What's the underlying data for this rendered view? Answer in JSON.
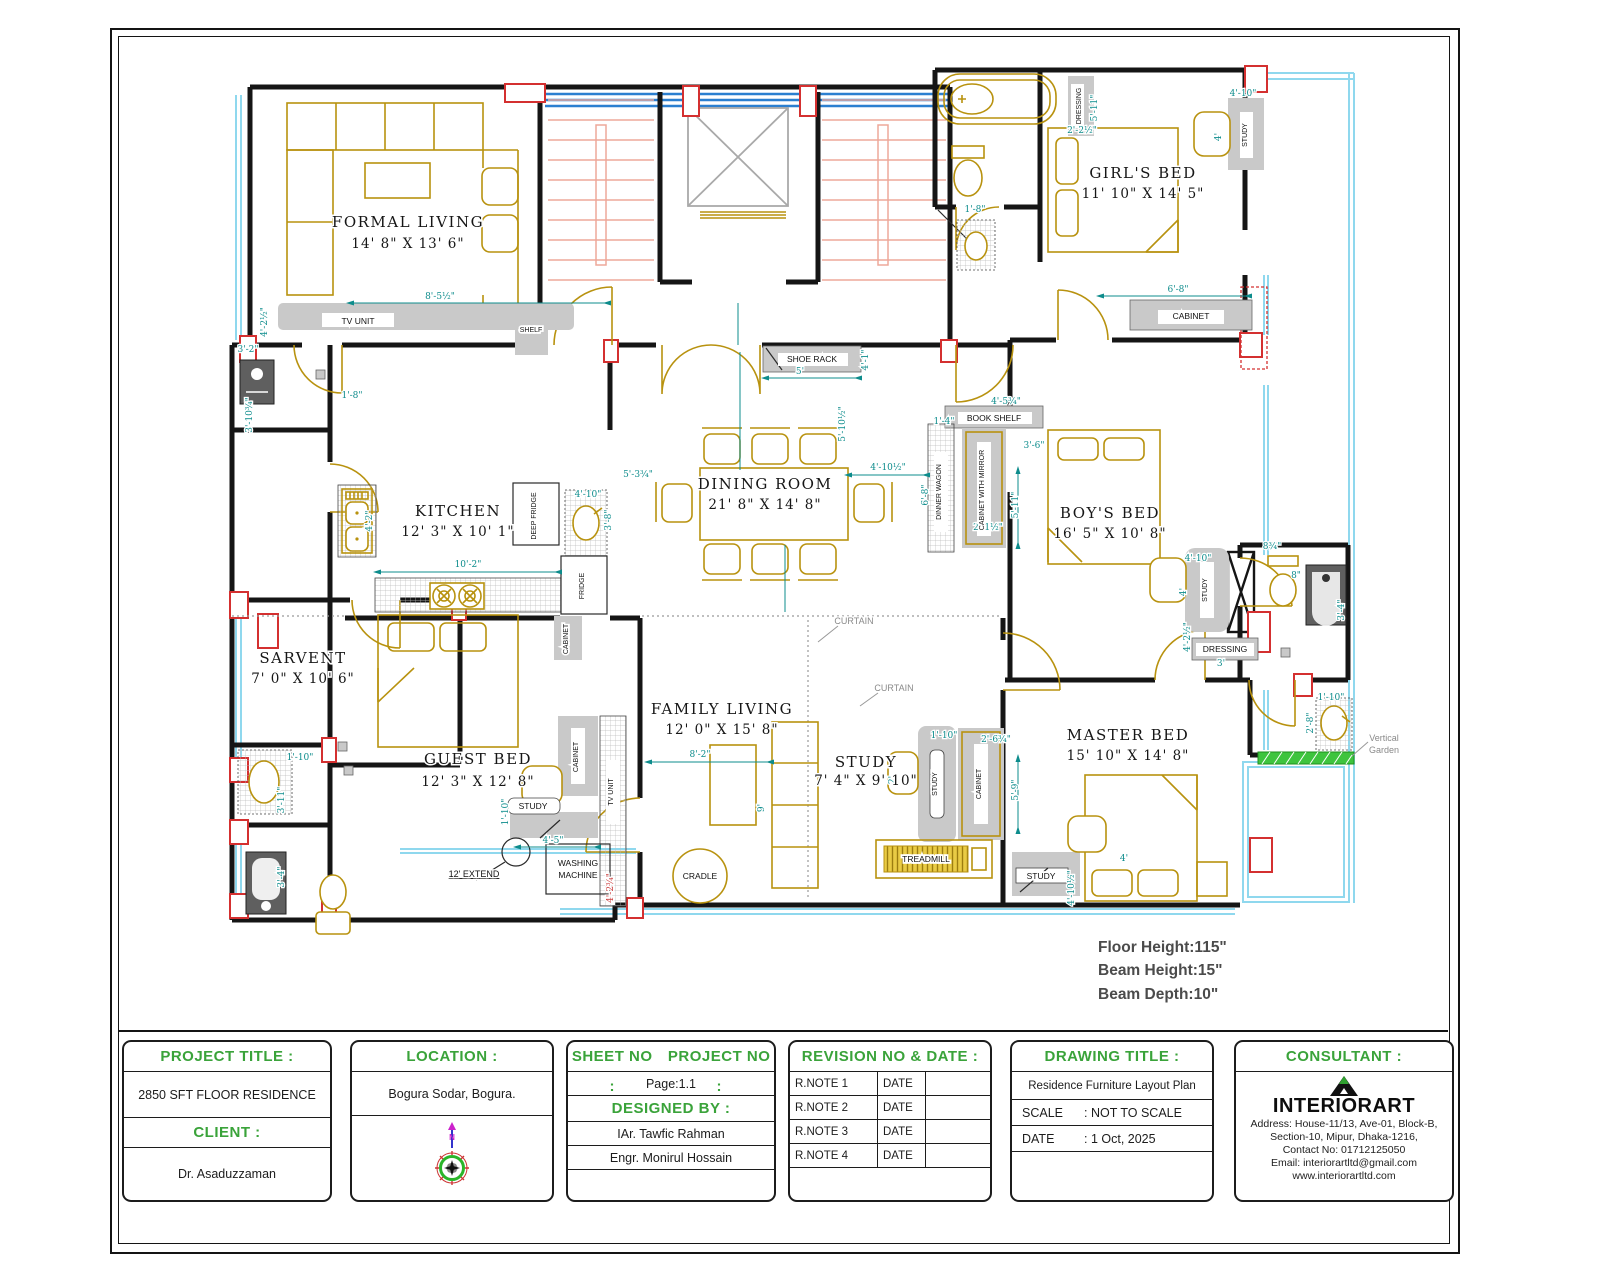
{
  "notes": {
    "floor_height": "Floor Height:115\"",
    "beam_height": "Beam Height:15\"",
    "beam_depth": "Beam Depth:10\""
  },
  "plan": {
    "rooms": {
      "formal_living": {
        "name": "FORMAL LIVING",
        "size": "14' 8\" X 13' 6\""
      },
      "girls_bed": {
        "name": "GIRL'S BED",
        "size": "11' 10\" X 14' 5\""
      },
      "dining": {
        "name": "DINING ROOM",
        "size": "21' 8\" X 14' 8\""
      },
      "kitchen": {
        "name": "KITCHEN",
        "size": "12' 3\" X 10' 1\""
      },
      "boys_bed": {
        "name": "BOY'S BED",
        "size": "16' 5\" X 10' 8\""
      },
      "sarvent": {
        "name": "SARVENT",
        "size": "7' 0\" X 10' 6\""
      },
      "guest_bed": {
        "name": "GUEST BED",
        "size": "12' 3\" X 12' 8\""
      },
      "family_living": {
        "name": "FAMILY LIVING",
        "size": "12' 0\" X 15' 8\""
      },
      "study": {
        "name": "STUDY",
        "size": "7' 4\" X 9' 10\""
      },
      "master_bed": {
        "name": "MASTER BED",
        "size": "15' 10\" X 14' 8\""
      }
    },
    "labels": {
      "tv_unit": "TV UNIT",
      "shelf": "SHELF",
      "shoe_rack": "SHOE RACK",
      "book_shelf": "BOOK SHELF",
      "dinner_wagon": "DINNER WAGON",
      "cabinet_with_mirror": "CABINET WITH MIRROR",
      "cabinet": "CABINET",
      "dressing": "DRESSING",
      "study": "STUDY",
      "deep_fridge": "DEEP FRIDGE",
      "fridge": "FRIDGE",
      "treadmill": "TREADMILL",
      "cradle": "CRADLE",
      "washing_1": "WASHING",
      "washing_2": "MACHINE",
      "curtain": "CURTAIN",
      "garden_1": "Vertical",
      "garden_2": "Garden",
      "extend": "12' EXTEND"
    },
    "dims": [
      "8'-5½\"",
      "4'-2½\"",
      "3'-2\"",
      "1'-8\"",
      "3'-10¾\"",
      "5'-3¾\"",
      "5'",
      "4'-1\"",
      "5'-10½\"",
      "4'-10½\"",
      "6'-8\"",
      "1'-4\"",
      "4'-5¾\"",
      "2'-1½\"",
      "5'-11\"",
      "3'-6\"",
      "4'-10\"",
      "4'",
      "3'",
      "4'-2½\"",
      "8¾\"",
      "3'-4\"",
      "8\"",
      "1'-10\"",
      "2'-8\"",
      "5'-9\"",
      "4'",
      "4'-10½\"",
      "8'-2\"",
      "9'",
      "10'-2\"",
      "4'-10\"",
      "3'-8\"",
      "4'-2\"",
      "1'-10\"",
      "3'-11\"",
      "3'-4\"",
      "1'-10\"",
      "4'-5\"",
      "4'-10\"",
      "6'-8\"",
      "1'-8\"",
      "5'-11\"",
      "2'-2½\"",
      "4'",
      "2'-6¾\"",
      "1'-10\"",
      "2'",
      "4'-2¾\""
    ]
  },
  "titleblock": {
    "project": {
      "heading": "PROJECT TITLE :",
      "value": "2850 SFT FLOOR RESIDENCE",
      "client_heading": "CLIENT :",
      "client": "Dr. Asaduzzaman"
    },
    "location": {
      "heading": "LOCATION :",
      "value": "Bogura Sodar, Bogura."
    },
    "sheet": {
      "heading_sheet": "SHEET NO :",
      "heading_project": "PROJECT NO :",
      "page": "Page:1.1",
      "designed_heading": "DESIGNED BY :",
      "designer1": "IAr. Tawfic Rahman",
      "designer2": "Engr. Monirul Hossain"
    },
    "revision": {
      "heading": "REVISION NO & DATE :",
      "rows": [
        {
          "note": "R.NOTE 1",
          "date": "DATE"
        },
        {
          "note": "R.NOTE 2",
          "date": "DATE"
        },
        {
          "note": "R.NOTE 3",
          "date": "DATE"
        },
        {
          "note": "R.NOTE 4",
          "date": "DATE"
        }
      ]
    },
    "drawing": {
      "heading": "DRAWING TITLE :",
      "title": "Residence Furniture Layout Plan",
      "scale_label": "SCALE",
      "scale_value": ": NOT TO SCALE",
      "date_label": "DATE",
      "date_value": ": 1 Oct, 2025"
    },
    "consultant": {
      "heading": "CONSULTANT :",
      "brand": "INTERIORART",
      "address1": "Address: House-11/13, Ave-01, Block-B,",
      "address2": "Section-10, Mipur, Dhaka-1216,",
      "address3": "Contact No: 01712125050",
      "address4": "Email: interiorartltd@gmail.com",
      "address5": "www.interiorartltd.com"
    }
  }
}
